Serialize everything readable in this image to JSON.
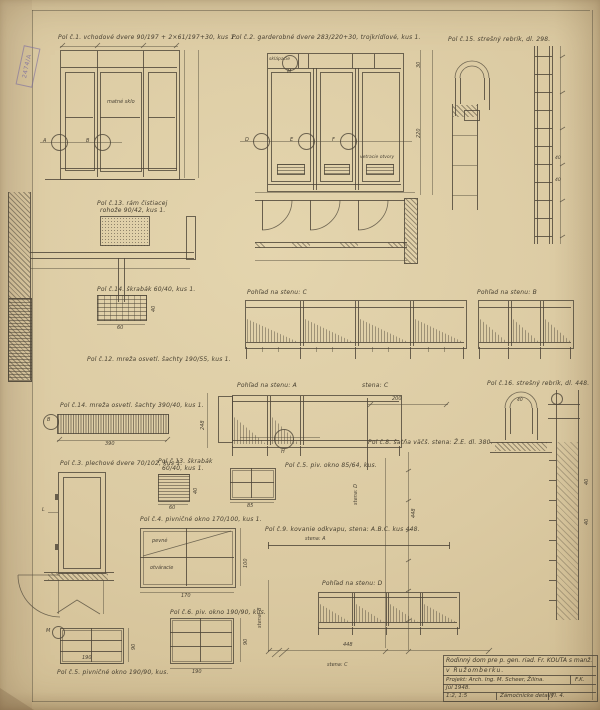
{
  "stamp": {
    "number": "2474/A"
  },
  "labels": {
    "pol1": "Pol č.1. vchodové dvere 90/197 + 2×61/197+30, kus 1.",
    "glass": "matné sklo",
    "pol2": "Pol č.2. garderobné dvere 283/220+30, trojkrídlové, kus 1.",
    "cell": "sklápacie",
    "vents": "vetracie otvory",
    "pol15": "Pol č.15. strešný rebrík, dl. 298.",
    "pol13a": "Pol č.13. rám čistiacej",
    "pol13b": "rohože 90/42, kus 1.",
    "pol14s": "Pol č.14. škrabák 60/40, kus 1.",
    "pol12": "Pol č.12. mreža osvetl. šachty 190/55, kus 1.",
    "pol14m": "Pol č.14. mreža osvetl. šachty 390/40, kus 1.",
    "view_c": "Pohľad na stenu: C",
    "view_b": "Pohľad na stenu: B",
    "view_a": "Pohľad na stenu: A",
    "view_d": "Pohľad na stenu: D",
    "stena_c_top": "stena: C",
    "stena_c_bot": "stena: C",
    "stena_a": "stena: A",
    "stena_b": "stena: B",
    "stena_d": "stena: D",
    "pol8": "Pol č.8. šatňa väčš. stena: Ž.E. dl. 380.",
    "pol16": "Pol č.16. strešný rebrík, dl. 448.",
    "pol3": "Pol č.3. plechové dvere 70/102, kus 1.",
    "pol13s_a": "Pol č.13. škrabák",
    "pol13s_b": "60/40, kus 1.",
    "pol5s": "Pol č.5. piv. okno 85/64, kus.",
    "pol4": "Pol č.4. pivničné okno 170/100, kus 1.",
    "pevne": "pevné",
    "otvaracie": "otváracie",
    "pol9": "Pol č.9. kovanie odkvapu, stena: A.B.C. kus 448.",
    "pol5": "Pol č.5. pivničné okno 190/90, kus.",
    "pol6": "Pol č.6. piv. okno 190/90, kus."
  },
  "markers": {
    "a": "A",
    "b": "B",
    "b2": "B",
    "d": "D",
    "e": "E",
    "f": "F",
    "h": "H",
    "l": "L",
    "m": "M",
    "m2": "M"
  },
  "dims": {
    "d30": "30",
    "d40": "40",
    "d60": "60",
    "d85": "85",
    "d90": "90",
    "d100": "100",
    "d170": "170",
    "d190": "190",
    "d200": "200",
    "d220": "220",
    "d248": "248",
    "d390": "390",
    "d448": "448"
  },
  "title_block": {
    "line1": "Rodinný dom pre p. gen. riad. Fr. KOUTA s manž.",
    "line2": "v Ružomberku.",
    "project": "Projekt: Arch. Ing. M. Scheer, Žilina.",
    "initials": "F.K.",
    "date": "Júl 1948.",
    "scale": "1:2, 1:5",
    "subject": "Zámočnícke detaily",
    "sheet_no": "Tl. 4."
  }
}
